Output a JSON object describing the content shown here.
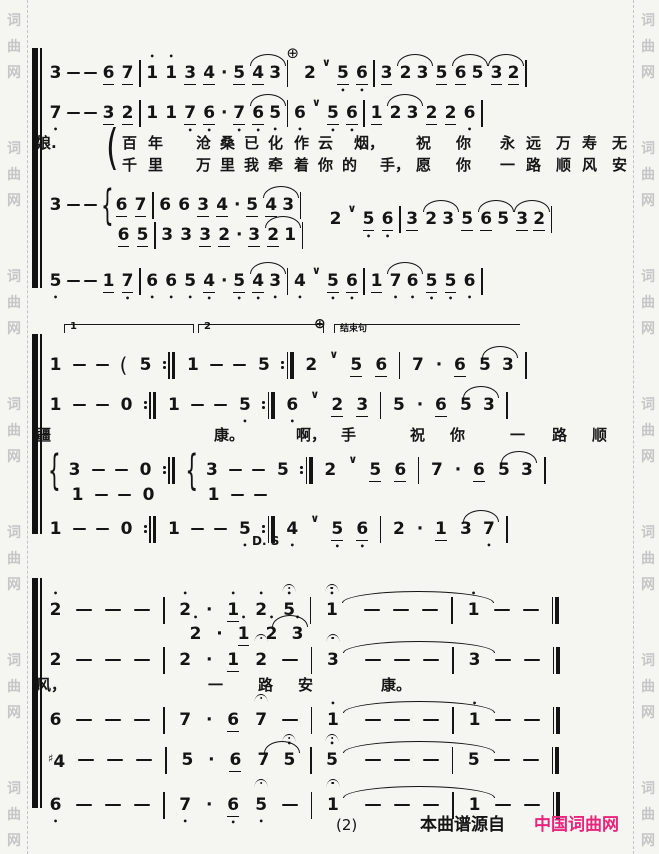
{
  "watermark": {
    "text": "词曲网",
    "color": "#c6c6c6"
  },
  "footer": {
    "page_number": "(2)",
    "source_prefix": "本曲谱源自",
    "source_site": "中国词曲网",
    "site_color": "#e9247c"
  },
  "labels": {
    "ds": "D. S",
    "ending_phrase": "结束句",
    "volta_first": "1",
    "volta_second": "2"
  },
  "systems": [
    {
      "top": 42,
      "height": 250,
      "rows": [
        {
          "kind": "music",
          "cls": "tight",
          "top": 16,
          "tokens": "3 - - 6_ 7_ | 1' 1' 3_ 4_ . 5_ 4_ ~ 3 | ⊕ 2 ∨ 5,_ 6,_ | 3_ 2 ~ 3 5_ 6_ ~ 5 3_ ~ 2_ |"
        },
        {
          "kind": "music",
          "cls": "tight",
          "top": 56,
          "tokens": "7, - - 3_ 2_ | 1 1 7,_ 6,_ . 7,_ 6,_ ~ 5, | 6, ∨ 5,_ 6,_ | 1_ 2 ~ 3 2_ 2_ 6, |"
        },
        {
          "kind": "label",
          "cls": "bigparen",
          "text": "(",
          "x": 106,
          "top": 86
        },
        {
          "kind": "lyrics",
          "top": 90,
          "words": [
            {
              "t": "娘.",
              "x": 36
            },
            {
              "t": "百",
              "x": 122
            },
            {
              "t": "年",
              "x": 148
            },
            {
              "t": "沧",
              "x": 196
            },
            {
              "t": "桑",
              "x": 220
            },
            {
              "t": "已",
              "x": 244
            },
            {
              "t": "化",
              "x": 268
            },
            {
              "t": "作",
              "x": 294
            },
            {
              "t": "云",
              "x": 318
            },
            {
              "t": "烟，",
              "x": 354
            },
            {
              "t": "祝",
              "x": 416
            },
            {
              "t": "你",
              "x": 456
            },
            {
              "t": "永",
              "x": 500
            },
            {
              "t": "远",
              "x": 526
            },
            {
              "t": "万",
              "x": 556
            },
            {
              "t": "寿",
              "x": 582
            },
            {
              "t": "无",
              "x": 612
            }
          ]
        },
        {
          "kind": "lyrics",
          "top": 112,
          "words": [
            {
              "t": "千",
              "x": 122
            },
            {
              "t": "里",
              "x": 148
            },
            {
              "t": "万",
              "x": 196
            },
            {
              "t": "里",
              "x": 220
            },
            {
              "t": "我",
              "x": 244
            },
            {
              "t": "牵",
              "x": 268
            },
            {
              "t": "着",
              "x": 294
            },
            {
              "t": "你",
              "x": 318
            },
            {
              "t": "的",
              "x": 342
            },
            {
              "t": "手，",
              "x": 380
            },
            {
              "t": "愿",
              "x": 416
            },
            {
              "t": "你",
              "x": 456
            },
            {
              "t": "一",
              "x": 500
            },
            {
              "t": "路",
              "x": 526
            },
            {
              "t": "顺",
              "x": 556
            },
            {
              "t": "风",
              "x": 582
            },
            {
              "t": "安",
              "x": 612
            }
          ]
        },
        {
          "kind": "music",
          "cls": "tight",
          "top": 148,
          "tokens": "3 - - { 6_ 7_ | 6 6 3_ 4_ . 5_ 4_ ~ 3 |"
        },
        {
          "kind": "music",
          "cls": "tight",
          "top": 162,
          "indent": 280,
          "tokens": "2 ∨ 5,_ 6,_ | 3_ 2 ~ 3 5_ 6_ ~ 5 3_ ~ 2_ |"
        },
        {
          "kind": "music",
          "cls": "tight",
          "top": 178,
          "indent": 68,
          "tokens": "6_ 5_ | 3 3 3_ 2_ . 3_ 2_ ~ 1 |"
        },
        {
          "kind": "music",
          "cls": "tight",
          "top": 224,
          "tokens": "5, - - 1_ 7,_ | 6, 6, 5, 4,_ . 5,_ 4,_ ~ 3, | 4, ∨ 5,_ 6,_ | 1_ 7, ~ 6, 5,_ 5,_ 6, |"
        }
      ]
    },
    {
      "top": 328,
      "height": 210,
      "rows": [
        {
          "kind": "volta",
          "label": "1",
          "x": 64,
          "w": 130,
          "top": -4
        },
        {
          "kind": "volta",
          "label": "2",
          "x": 198,
          "w": 126,
          "top": -4
        },
        {
          "kind": "label",
          "cls": "codalbl",
          "text": "⊕",
          "x": 314,
          "top": -12
        },
        {
          "kind": "volta",
          "cls": "ending",
          "label": "结束句",
          "x": 334,
          "w": 186,
          "top": -4
        },
        {
          "kind": "music",
          "cls": "mid",
          "top": 22,
          "tokens": "1 - - ( 5 :‖ 1 - - 5 :‖ 2 ∨ 5_ 6_ | 7 . 6_ 5 ~ 3 |"
        },
        {
          "kind": "music",
          "cls": "mid",
          "top": 62,
          "tokens": "1 - - 0 :‖ 1 - - 5, :‖ 6, ∨ 2_ 3_ | 5 . 6_ 5 ~ 3 |"
        },
        {
          "kind": "lyrics",
          "top": 96,
          "words": [
            {
              "t": "疆",
              "x": 36
            },
            {
              "t": "康。",
              "x": 214
            },
            {
              "t": "啊，",
              "x": 296
            },
            {
              "t": "手",
              "x": 341
            },
            {
              "t": "祝",
              "x": 410
            },
            {
              "t": "你",
              "x": 450
            },
            {
              "t": "一",
              "x": 510
            },
            {
              "t": "路",
              "x": 552
            },
            {
              "t": "顺",
              "x": 592
            }
          ]
        },
        {
          "kind": "music",
          "cls": "mid",
          "top": 127,
          "tokens": "{ 3 - - 0 :‖ { 3 - - 5 :‖ 2 ∨ 5_ 6_ | 7 . 6_ 5 ~ 3 |"
        },
        {
          "kind": "music",
          "cls": "mid",
          "top": 152,
          "indent": 22,
          "tokens": "1 - - 0 sp 1 - -"
        },
        {
          "kind": "music",
          "cls": "mid",
          "top": 186,
          "tokens": "1 - - 0 :‖ 1 - - 5, :‖ 4, ∨ 5,_ 6,_ | 2 . 1_ 3 ~ 7, |"
        },
        {
          "kind": "label",
          "cls": "ds",
          "text": "D. S",
          "x": 252,
          "top": 206
        }
      ]
    },
    {
      "top": 572,
      "height": 240,
      "rows": [
        {
          "kind": "music",
          "cls": "wide",
          "top": 23,
          "tokens": "2' - - - | 2' . 1'_ 2' ^5' | ^1' ~>150 - - - | 1' - - ‖"
        },
        {
          "kind": "music",
          "cls": "wide",
          "top": 47,
          "indent": 140,
          "tokens": "2' . 1'_ 2' ~ 3'"
        },
        {
          "kind": "music",
          "cls": "wide",
          "top": 73,
          "tokens": "2 - - - | 2 . 1_ ^2 - | ^3 ~>150 - - - | 3 - - ‖"
        },
        {
          "kind": "lyrics",
          "top": 102,
          "words": [
            {
              "t": "风，",
              "x": 36
            },
            {
              "t": "一",
              "x": 208
            },
            {
              "t": "路",
              "x": 258
            },
            {
              "t": "安",
              "x": 298
            },
            {
              "t": "康。",
              "x": 381
            }
          ]
        },
        {
          "kind": "music",
          "cls": "wide",
          "top": 133,
          "tokens": "6 - - - | 7 . 6_ ^7 - | 1' ~>150 - - - | 1' - - ‖"
        },
        {
          "kind": "music",
          "cls": "wide",
          "top": 173,
          "tokens": "#4 - - - | 5 . 6_ 7 ~ ^5' | ^5' ~>150 - - - | 5 - - ‖"
        },
        {
          "kind": "music",
          "cls": "wide",
          "top": 218,
          "tokens": "6, - - - | 7, . 6,_ ^5, - | ^1 ~>150 - - - | 1 - - ‖"
        }
      ]
    }
  ]
}
